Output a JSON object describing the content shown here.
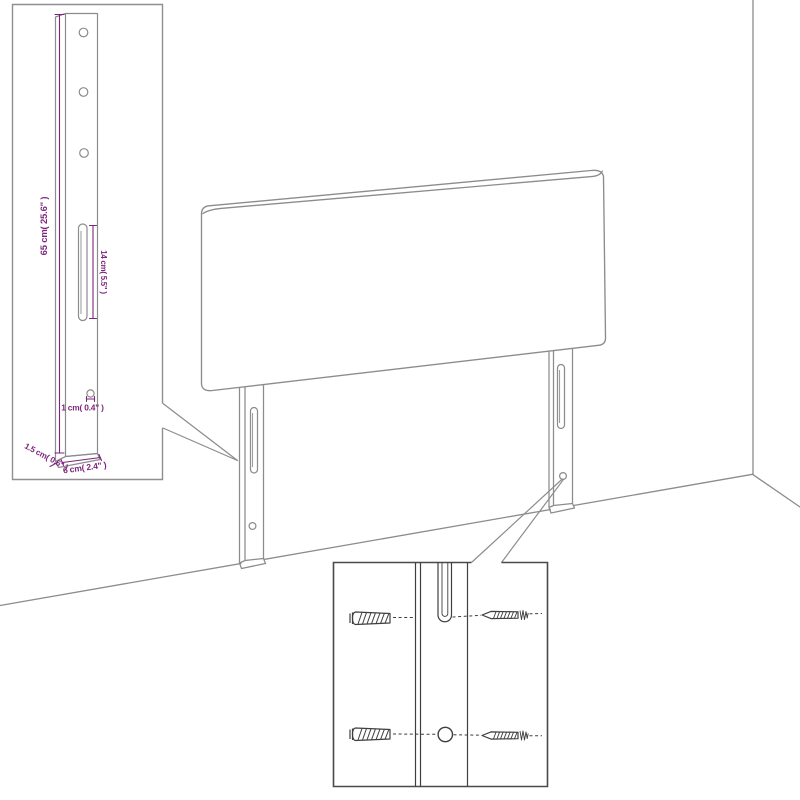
{
  "canvas": {
    "width": 800,
    "height": 800,
    "background": "#ffffff"
  },
  "diagram": {
    "subject": "upholstered headboard with two slotted mounting legs shown against a wall corner, with a leg dimension inset and a fastener detail inset",
    "colors": {
      "main_outline": "#8c8c8c",
      "inset_border_light": "#8f8f8f",
      "inset_border_dark": "#4a4a4a",
      "detail_outline": "#3f3f3f",
      "dimension": "#7d257d",
      "background": "#ffffff"
    },
    "leg_detail_inset": {
      "dimensions": {
        "leg_height": "65 cm( 25.6\" )",
        "slot_length": "14 cm( 5.5\" )",
        "hole_diameter": "1 cm( 0.4\" )",
        "board_thickness": "1.5 cm( 0.6\" )",
        "leg_width": "6 cm( 2.4\" )"
      }
    },
    "fastener_detail_inset": {
      "parts": [
        "wall-plug",
        "screw",
        "mounting-slot",
        "mounting-hole"
      ]
    }
  }
}
